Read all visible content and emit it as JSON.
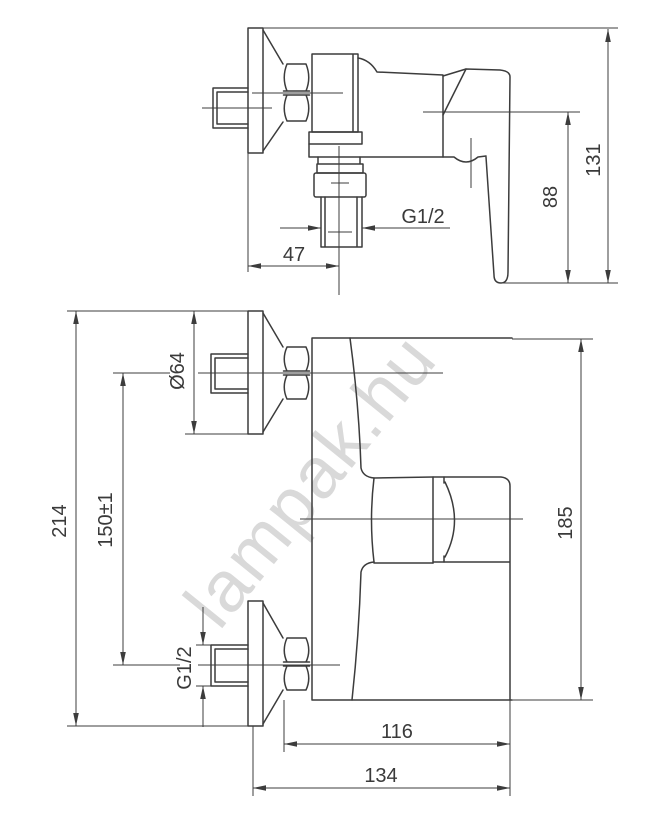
{
  "page": {
    "background_color": "#ffffff",
    "line_color": "#3c3c3c",
    "text_color": "#3a3a3a",
    "watermark_color": "#d9d9d9"
  },
  "drawing": {
    "watermark": "lampak.hu",
    "top_view": {
      "dimensions": {
        "overall_height": "131",
        "handle_height": "88",
        "outlet_thread": "G1/2",
        "outlet_distance": "47"
      }
    },
    "front_view": {
      "dimensions": {
        "flange_diameter": "Ø64",
        "overall_length": "214",
        "connection_spacing": "150±1",
        "body_length": "185",
        "connection_thread": "G1/2",
        "depth_to_handle": "116",
        "overall_depth": "134"
      }
    }
  }
}
